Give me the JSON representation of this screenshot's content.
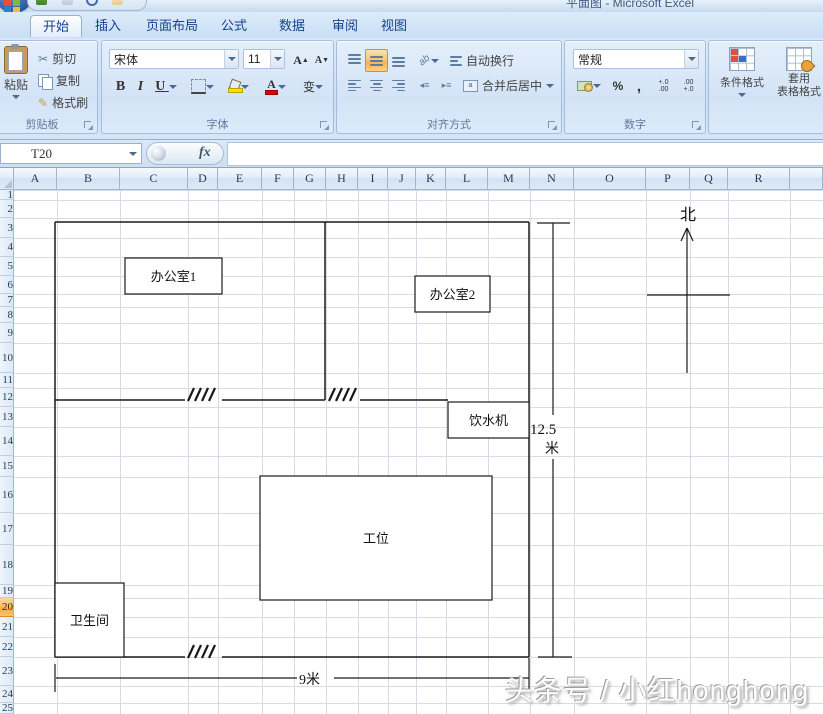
{
  "title_bar": {
    "title": "平面图 - Microsoft Excel"
  },
  "ribbon": {
    "tabs": [
      {
        "label": "开始",
        "active": true
      },
      {
        "label": "插入",
        "active": false
      },
      {
        "label": "页面布局",
        "active": false
      },
      {
        "label": "公式",
        "active": false
      },
      {
        "label": "数据",
        "active": false
      },
      {
        "label": "审阅",
        "active": false
      },
      {
        "label": "视图",
        "active": false
      }
    ],
    "clipboard": {
      "label": "剪贴板",
      "paste": "粘贴",
      "cut": "剪切",
      "copy": "复制",
      "format_painter": "格式刷"
    },
    "font": {
      "label": "字体",
      "font_name": "宋体",
      "font_size": "11",
      "bold": "B",
      "italic": "I",
      "underline": "U",
      "phonetic": "变"
    },
    "alignment": {
      "label": "对齐方式",
      "wrap_text": "自动换行",
      "merge_center": "合并后居中"
    },
    "number": {
      "label": "数字",
      "format": "常规",
      "percent": "%",
      "comma": ","
    },
    "styles": {
      "conditional_formatting": "条件格式",
      "format_as_table_line1": "套用",
      "format_as_table_line2": "表格格式"
    },
    "icons": {
      "cut": "✂",
      "format_painter": "✎",
      "increase_font": "A",
      "decrease_font": "A",
      "inc_decimal_top": "+.0",
      "inc_decimal_bot": ".00",
      "dec_decimal_top": ".00",
      "dec_decimal_bot": "+.0",
      "orientation": "ab"
    }
  },
  "formula_bar": {
    "name_box": "T20",
    "fx_label": "fx",
    "formula_value": ""
  },
  "sheet": {
    "selected_row": 20,
    "columns": [
      {
        "label": "A",
        "x1": 14,
        "x2": 57
      },
      {
        "label": "B",
        "x1": 57,
        "x2": 120
      },
      {
        "label": "C",
        "x1": 120,
        "x2": 188
      },
      {
        "label": "D",
        "x1": 188,
        "x2": 218
      },
      {
        "label": "E",
        "x1": 218,
        "x2": 262
      },
      {
        "label": "F",
        "x1": 262,
        "x2": 294
      },
      {
        "label": "G",
        "x1": 294,
        "x2": 326
      },
      {
        "label": "H",
        "x1": 326,
        "x2": 358
      },
      {
        "label": "I",
        "x1": 358,
        "x2": 388
      },
      {
        "label": "J",
        "x1": 388,
        "x2": 416
      },
      {
        "label": "K",
        "x1": 416,
        "x2": 446
      },
      {
        "label": "L",
        "x1": 446,
        "x2": 488
      },
      {
        "label": "M",
        "x1": 488,
        "x2": 530
      },
      {
        "label": "N",
        "x1": 530,
        "x2": 574
      },
      {
        "label": "O",
        "x1": 574,
        "x2": 646
      },
      {
        "label": "P",
        "x1": 646,
        "x2": 690
      },
      {
        "label": "Q",
        "x1": 690,
        "x2": 728
      },
      {
        "label": "R",
        "x1": 728,
        "x2": 790
      },
      {
        "label": "",
        "x1": 790,
        "x2": 823
      }
    ],
    "row_boundaries": [
      190,
      200,
      218,
      238,
      257,
      276,
      294,
      307,
      323,
      343,
      373,
      388,
      407,
      427,
      456,
      477,
      513,
      545,
      585,
      598,
      617,
      637,
      657,
      686,
      703,
      714
    ],
    "gridline_color": "#d5dce8"
  },
  "drawing": {
    "line_color": "#1a1a1a",
    "walls": [
      [
        55,
        222,
        529,
        222
      ],
      [
        55,
        222,
        55,
        657
      ],
      [
        529,
        222,
        529,
        657
      ],
      [
        55,
        657,
        185,
        657
      ],
      [
        222,
        657,
        529,
        657
      ],
      [
        325,
        222,
        325,
        400
      ],
      [
        55,
        400,
        185,
        400
      ],
      [
        222,
        400,
        325,
        400
      ],
      [
        360,
        400,
        448,
        400
      ]
    ],
    "door_marks": [
      {
        "x": 188,
        "y": 400
      },
      {
        "x": 329,
        "y": 400
      },
      {
        "x": 188,
        "y": 657
      }
    ],
    "rooms": [
      {
        "name": "office1-box",
        "label": "办公室1",
        "x": 125,
        "y": 258,
        "w": 97,
        "h": 36
      },
      {
        "name": "office2-box",
        "label": "办公室2",
        "x": 415,
        "y": 276,
        "w": 75,
        "h": 36
      },
      {
        "name": "water-dispenser-box",
        "label": "饮水机",
        "x": 448,
        "y": 402,
        "w": 81,
        "h": 36
      },
      {
        "name": "workstation-box",
        "label": "工位",
        "x": 260,
        "y": 476,
        "w": 232,
        "h": 124
      },
      {
        "name": "restroom-box",
        "label": "卫生间",
        "x": 55,
        "y": 583,
        "w": 69,
        "h": 74
      }
    ],
    "dimension_vertical": {
      "value": "12.5",
      "unit": "米",
      "x": 553,
      "y_top": 223,
      "y_break1": 415,
      "y_break2": 459,
      "y_bottom": 657
    },
    "dimension_horizontal": {
      "value": "9米",
      "y": 678,
      "x_left": 55,
      "x_break1": 297,
      "x_break2": 334,
      "x_right": 529
    },
    "north": {
      "label": "北",
      "x": 687,
      "arrow_top": 228,
      "arrow_bottom": 373,
      "cross_y": 295,
      "cross_x1": 647,
      "cross_x2": 730
    }
  },
  "watermark": {
    "text": "头条号 / 小红honghong"
  }
}
